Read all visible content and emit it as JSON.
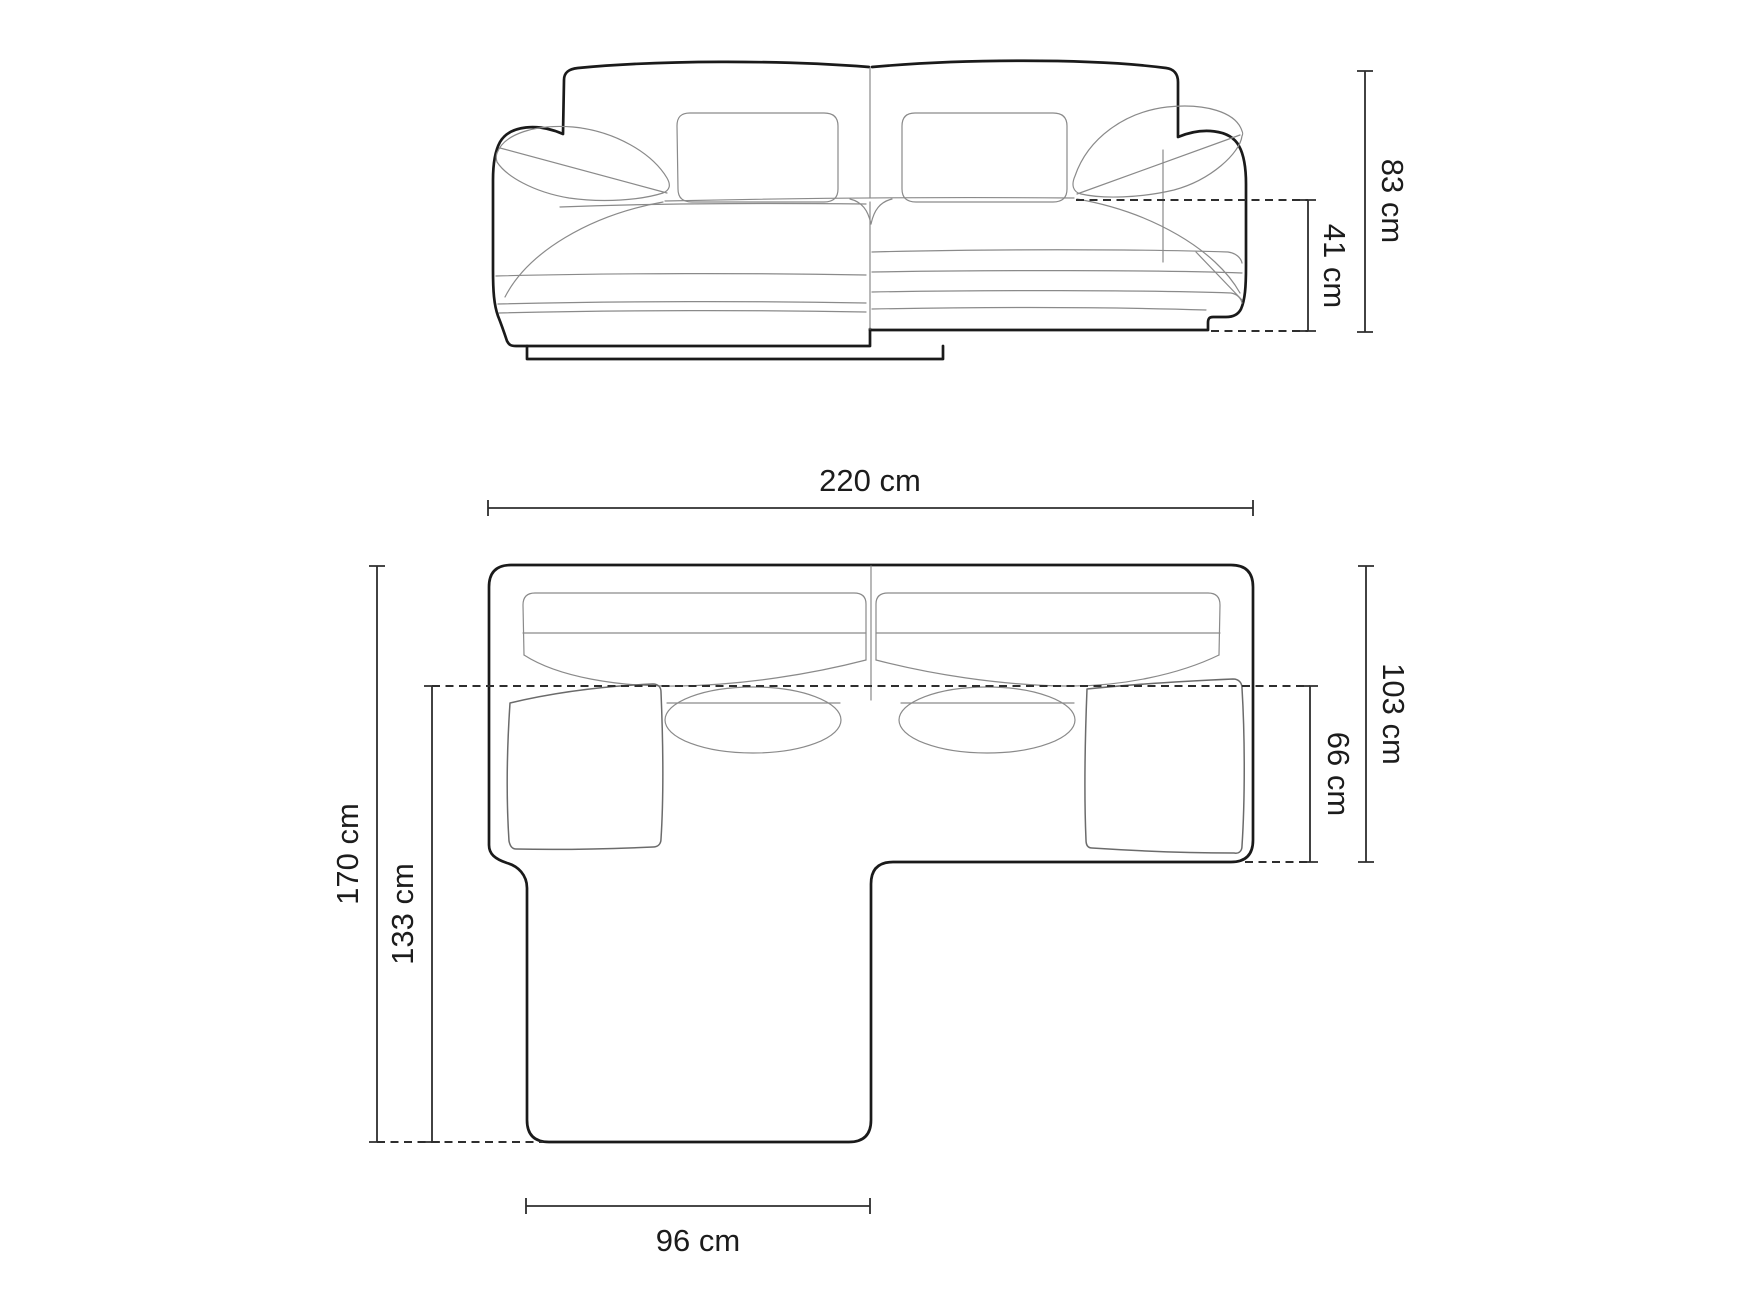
{
  "page": {
    "background": "#ffffff",
    "outline_color": "#1a1a1a",
    "seam_color": "#8a8a8a",
    "dimension_color": "#2e2e2e",
    "label_color": "#1c1c1c"
  },
  "views": {
    "front_elevation": {
      "description": "corner sofa front elevation line drawing",
      "dims": {
        "total_height": "83 cm",
        "seat_height": "41 cm"
      }
    },
    "top_plan": {
      "description": "corner sofa top plan line drawing with chaise",
      "dims": {
        "total_width": "220 cm",
        "total_depth": "170 cm",
        "chaise_length": "133 cm",
        "body_depth": "103 cm",
        "seat_depth": "66 cm",
        "chaise_width": "96 cm"
      }
    }
  }
}
